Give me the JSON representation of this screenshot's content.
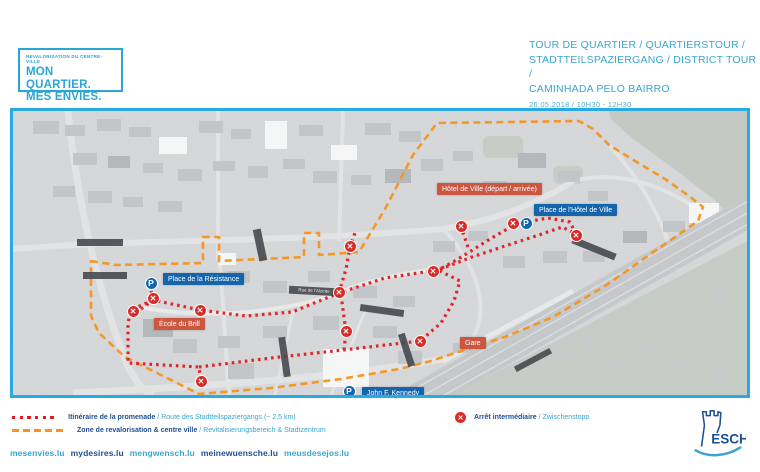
{
  "brand_box": {
    "eyebrow": "REVALORISATION DU CENTRE-VILLE",
    "line1": "MON QUARTIER.",
    "line2": "MES ENVIES."
  },
  "header": {
    "title_line1": "TOUR DE QUARTIER / QUARTIERSTOUR /",
    "title_line2": "STADTTEILSPAZIERGANG / DISTRICT TOUR /",
    "title_line3": "CAMINHADA PELO BAIRRO",
    "datetime": "26.05.2018 / 10H30 - 12H30"
  },
  "map": {
    "colors": {
      "border_cyan": "#29abe2",
      "route_red": "#e31b23",
      "zone_orange": "#f7941e",
      "label_red_bg": "#cc5740",
      "label_blue_bg": "#1565ad",
      "stop_marker_red": "#d92b27",
      "parking_blue": "#1565ad"
    },
    "street_label": "Rue de l'Alzette",
    "labels": [
      {
        "id": "hotel-de-ville-depart",
        "text": "Hôtel de Ville (départ / arrivée)",
        "type": "red",
        "x": 424,
        "y": 72
      },
      {
        "id": "place-hotel-de-ville",
        "text": "Place de l'Hôtel de Ville",
        "type": "blue",
        "x": 521,
        "y": 93
      },
      {
        "id": "place-de-la-resistance",
        "text": "Place de la Résistance",
        "type": "blue",
        "x": 150,
        "y": 162
      },
      {
        "id": "ecole-du-brill",
        "text": "École du Brill",
        "type": "red",
        "x": 141,
        "y": 207
      },
      {
        "id": "gare",
        "text": "Gare",
        "type": "red",
        "x": 447,
        "y": 226
      },
      {
        "id": "john-f-kennedy",
        "text": "John F. Kennedy",
        "type": "blue",
        "x": 349,
        "y": 276
      }
    ],
    "marker_glyphs": {
      "stop": "✕",
      "parking": "P"
    },
    "x_markers": [
      [
        140,
        187
      ],
      [
        120,
        200
      ],
      [
        187,
        199
      ],
      [
        188,
        270
      ],
      [
        326,
        181
      ],
      [
        337,
        135
      ],
      [
        333,
        220
      ],
      [
        407,
        230
      ],
      [
        448,
        115
      ],
      [
        500,
        112
      ],
      [
        563,
        124
      ],
      [
        420,
        160
      ]
    ],
    "p_markers": [
      [
        138,
        172
      ],
      [
        513,
        112
      ],
      [
        336,
        280
      ]
    ]
  },
  "legend": {
    "sep": "/",
    "route": {
      "fr": "Itinéraire de la promenade",
      "de": "Route des Stadtteilspaziergangs (~ 2,5 km)"
    },
    "zone": {
      "fr": "Zone de revalorisation & centre ville",
      "de": "Revitalisierungsbereich & Stadtzentrum"
    },
    "stop": {
      "fr": "Arrêt intermédiaire",
      "de": "Zwischenstopp"
    }
  },
  "footer": {
    "links": [
      {
        "text": "mesenvies.lu",
        "tone": "teal"
      },
      {
        "text": "mydesires.lu",
        "tone": "navy"
      },
      {
        "text": "mengwensch.lu",
        "tone": "teal"
      },
      {
        "text": "meinewuensche.lu",
        "tone": "navy"
      },
      {
        "text": "meusdesejos.lu",
        "tone": "teal"
      }
    ]
  },
  "logo": {
    "text": "ESCH"
  }
}
